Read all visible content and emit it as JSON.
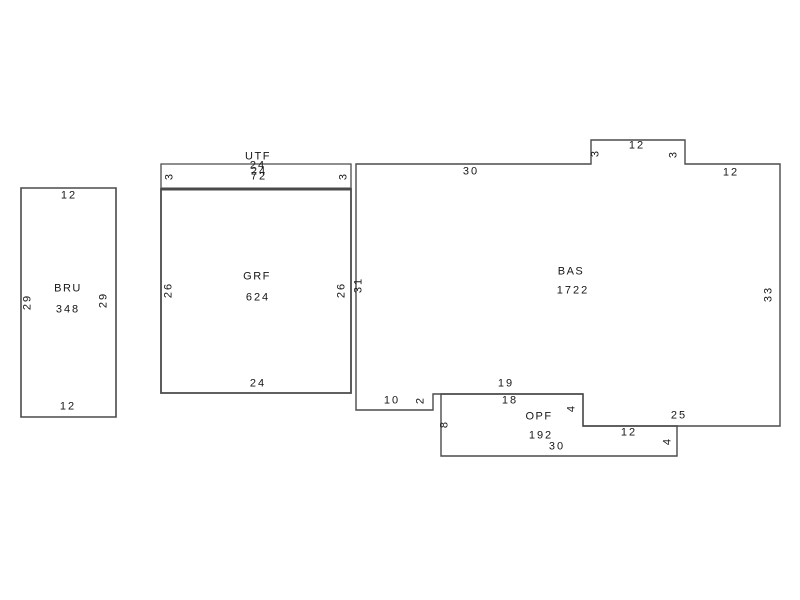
{
  "canvas": {
    "width": 800,
    "height": 600,
    "background": "#ffffff",
    "line_color": "#4a4a4a",
    "text_color": "#161616"
  },
  "rooms": [
    {
      "id": "BRU",
      "name": "BRU",
      "area": "348",
      "stroke_width": 1.6,
      "polygon": [
        [
          21,
          188
        ],
        [
          116,
          188
        ],
        [
          116,
          417
        ],
        [
          21,
          417
        ]
      ],
      "name_pos": [
        68,
        289
      ],
      "area_pos": [
        68,
        310
      ],
      "dims": [
        {
          "text": "12",
          "x": 69,
          "y": 196,
          "rot": 0
        },
        {
          "text": "12",
          "x": 68,
          "y": 407,
          "rot": 0
        },
        {
          "text": "29",
          "x": 28,
          "y": 302,
          "rot": -90
        },
        {
          "text": "29",
          "x": 104,
          "y": 300,
          "rot": -90
        }
      ]
    },
    {
      "id": "UTF",
      "name": "UTF",
      "area": "72",
      "stroke_width": 1.3,
      "polygon": [
        [
          161,
          164
        ],
        [
          351,
          164
        ],
        [
          351,
          189
        ],
        [
          161,
          189
        ]
      ],
      "name_pos": [
        258,
        157
      ],
      "area_pos": [
        259,
        177
      ],
      "dims": [
        {
          "text": "3",
          "x": 170,
          "y": 176,
          "rot": -90
        },
        {
          "text": "3",
          "x": 344,
          "y": 176,
          "rot": -90
        },
        {
          "text": "24",
          "x": 258,
          "y": 166,
          "rot": 0
        },
        {
          "text": "24",
          "x": 259,
          "y": 172,
          "rot": 0
        }
      ]
    },
    {
      "id": "GRF",
      "name": "GRF",
      "area": "624",
      "stroke_width": 1.8,
      "polygon": [
        [
          161,
          189
        ],
        [
          351,
          189
        ],
        [
          351,
          393
        ],
        [
          161,
          393
        ]
      ],
      "name_pos": [
        257,
        277
      ],
      "area_pos": [
        258,
        298
      ],
      "dims": [
        {
          "text": "26",
          "x": 169,
          "y": 290,
          "rot": -90
        },
        {
          "text": "26",
          "x": 342,
          "y": 290,
          "rot": -90
        },
        {
          "text": "24",
          "x": 258,
          "y": 384,
          "rot": 0
        }
      ]
    },
    {
      "id": "BAS",
      "name": "BAS",
      "area": "1722",
      "stroke_width": 1.4,
      "polygon": [
        [
          356,
          164
        ],
        [
          591,
          164
        ],
        [
          591,
          140
        ],
        [
          685,
          140
        ],
        [
          685,
          164
        ],
        [
          780,
          164
        ],
        [
          780,
          426
        ],
        [
          583,
          426
        ],
        [
          583,
          394
        ],
        [
          433,
          394
        ],
        [
          433,
          410
        ],
        [
          356,
          410
        ]
      ],
      "name_pos": [
        571,
        272
      ],
      "area_pos": [
        573,
        291
      ],
      "dims": [
        {
          "text": "30",
          "x": 471,
          "y": 172,
          "rot": 0
        },
        {
          "text": "3",
          "x": 596,
          "y": 153,
          "rot": -90
        },
        {
          "text": "12",
          "x": 637,
          "y": 146,
          "rot": 0
        },
        {
          "text": "3",
          "x": 674,
          "y": 154,
          "rot": -90
        },
        {
          "text": "12",
          "x": 731,
          "y": 173,
          "rot": 0
        },
        {
          "text": "33",
          "x": 769,
          "y": 294,
          "rot": -90
        },
        {
          "text": "25",
          "x": 679,
          "y": 416,
          "rot": 0
        },
        {
          "text": "31",
          "x": 359,
          "y": 285,
          "rot": -90
        },
        {
          "text": "10",
          "x": 392,
          "y": 401,
          "rot": 0
        },
        {
          "text": "2",
          "x": 421,
          "y": 400,
          "rot": -90
        },
        {
          "text": "19",
          "x": 506,
          "y": 384,
          "rot": 0
        }
      ]
    },
    {
      "id": "OPF",
      "name": "OPF",
      "area": "192",
      "stroke_width": 1.4,
      "polygon": [
        [
          441,
          394
        ],
        [
          583,
          394
        ],
        [
          583,
          426
        ],
        [
          677,
          426
        ],
        [
          677,
          456
        ],
        [
          441,
          456
        ]
      ],
      "name_pos": [
        539,
        417
      ],
      "area_pos": [
        541,
        436
      ],
      "dims": [
        {
          "text": "18",
          "x": 510,
          "y": 401,
          "rot": 0
        },
        {
          "text": "4",
          "x": 572,
          "y": 408,
          "rot": -90
        },
        {
          "text": "12",
          "x": 629,
          "y": 433,
          "rot": 0
        },
        {
          "text": "4",
          "x": 668,
          "y": 441,
          "rot": -90
        },
        {
          "text": "30",
          "x": 557,
          "y": 447,
          "rot": 0
        },
        {
          "text": "8",
          "x": 445,
          "y": 424,
          "rot": -90
        }
      ]
    }
  ],
  "extra_lines": [
    {
      "x1": 161,
      "y1": 189,
      "x2": 351,
      "y2": 189,
      "width": 3
    }
  ]
}
